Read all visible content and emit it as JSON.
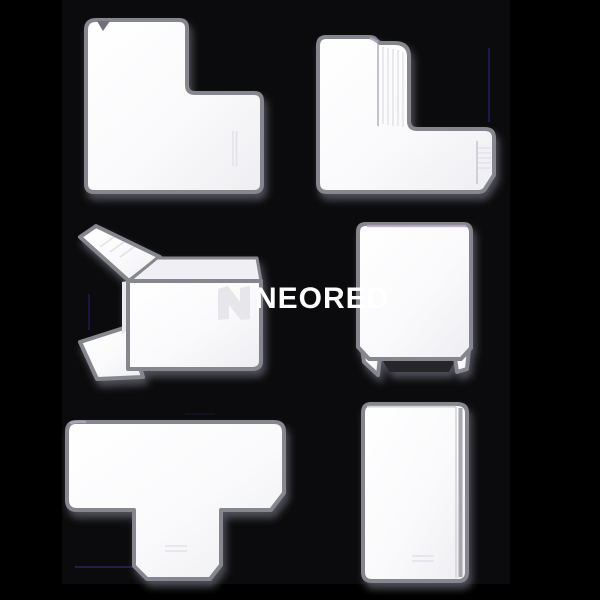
{
  "watermark": {
    "brand": "NEORED",
    "logo_icon": "neored-logo-icon"
  },
  "colors": {
    "background": "#000000",
    "photo_background": "#0b0b0d",
    "product_fill": "#fbfbfd",
    "product_outline": "#86868e",
    "ridge": "#e1e1e8",
    "dark_foot": "#26262b",
    "lavender_tint": "#b3a8c6",
    "artifact_blue": "#2a2a80",
    "watermark_text": "#ffffff",
    "watermark_logo": "#e3e3e9"
  },
  "products": [
    {
      "id": "flat-angle-fitting",
      "position": "top-left"
    },
    {
      "id": "internal-angle-fitting",
      "position": "top-right"
    },
    {
      "id": "external-angle-fitting",
      "position": "middle-left"
    },
    {
      "id": "end-cap-fitting",
      "position": "middle-right"
    },
    {
      "id": "tee-fitting",
      "position": "bottom-left"
    },
    {
      "id": "straight-joint-fitting",
      "position": "bottom-right"
    }
  ]
}
